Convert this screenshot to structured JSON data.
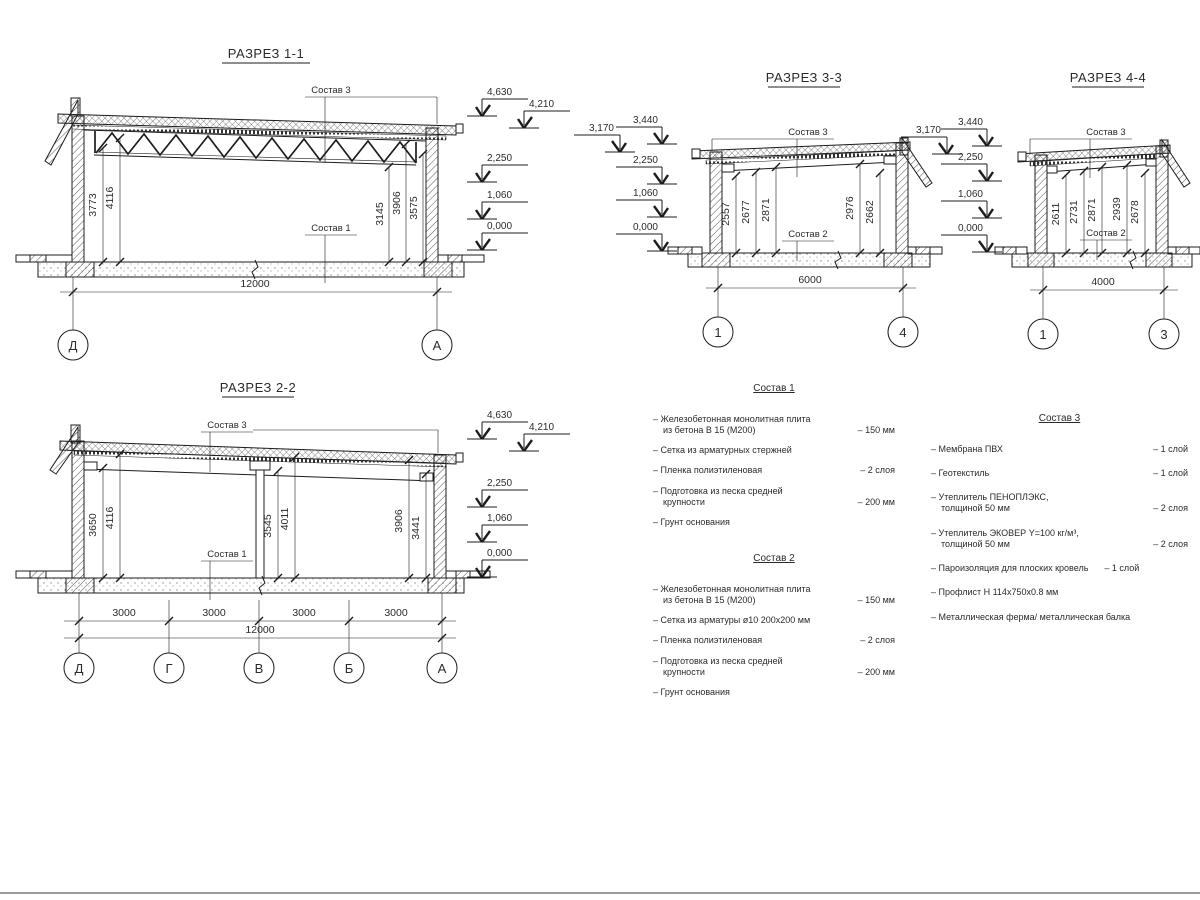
{
  "page": {
    "background": "#ffffff",
    "line_color": "#1c1c1c",
    "text_color": "#2b2b2b",
    "bottom_rule_color": "#9b9b9b"
  },
  "sections": {
    "s11": {
      "title": "РАЗРЕЗ 1-1",
      "top_label": "Состав 3",
      "bottom_label": "Состав 1",
      "dim_left_1": "3773",
      "dim_left_2": "4116",
      "dim_right_1": "3145",
      "dim_right_2": "3906",
      "dim_right_3": "3575",
      "total": "12000",
      "grid_left": "Д",
      "grid_right": "А",
      "elev_1": "4,630",
      "elev_2": "4,210",
      "elev_3": "2,250",
      "elev_4": "1,060",
      "elev_5": "0,000"
    },
    "s22": {
      "title": "РАЗРЕЗ 2-2",
      "top_label": "Состав 3",
      "bottom_label": "Состав 1",
      "dim_1": "3650",
      "dim_2": "4116",
      "dim_3": "3545",
      "dim_4": "4011",
      "dim_5": "3906",
      "dim_6": "3441",
      "span": "3000",
      "total": "12000",
      "grid_1": "Д",
      "grid_2": "Г",
      "grid_3": "В",
      "grid_4": "Б",
      "grid_5": "А",
      "elev_1": "4,630",
      "elev_2": "4,210",
      "elev_3": "2,250",
      "elev_4": "1,060",
      "elev_5": "0,000"
    },
    "s33": {
      "title": "РАЗРЕЗ 3-3",
      "top_label": "Состав 3",
      "bottom_label": "Состав 2",
      "dim_1": "2557",
      "dim_2": "2677",
      "dim_3": "2871",
      "dim_4": "2976",
      "dim_5": "2662",
      "total": "6000",
      "grid_1": "1",
      "grid_2": "4",
      "elev_0": "3,170",
      "elev_1": "3,440",
      "elev_2": "2,250",
      "elev_3": "1,060",
      "elev_4": "0,000"
    },
    "s44": {
      "title": "РАЗРЕЗ 4-4",
      "top_label": "Состав 3",
      "bottom_label": "Состав 2",
      "dim_1": "2611",
      "dim_2": "2731",
      "dim_3": "2871",
      "dim_4": "2939",
      "dim_5": "2678",
      "total": "4000",
      "grid_1": "1",
      "grid_2": "3",
      "elev_0": "3,170",
      "elev_1": "3,440",
      "elev_2": "2,250",
      "elev_3": "1,060",
      "elev_4": "0,000"
    }
  },
  "lists": {
    "s1": {
      "title": "Состав 1",
      "items": [
        {
          "text": "– Железобетонная  монолитная плита\nиз бетона В 15 (М200)",
          "value": "– 150 мм"
        },
        {
          "text": "– Сетка из арматурных стержней",
          "value": ""
        },
        {
          "text": "– Пленка полиэтиленовая",
          "value": "– 2 слоя"
        },
        {
          "text": "– Подготовка из песка средней\nкрупности",
          "value": "– 200 мм"
        },
        {
          "text": "– Грунт основания",
          "value": ""
        }
      ]
    },
    "s2": {
      "title": "Состав 2",
      "items": [
        {
          "text": "– Железобетонная  монолитная плита\nиз бетона В 15 (М200)",
          "value": "– 150 мм"
        },
        {
          "text": "– Сетка из арматуры ø10 200х200 мм",
          "value": ""
        },
        {
          "text": "– Пленка полиэтиленовая",
          "value": "– 2 слоя"
        },
        {
          "text": "– Подготовка из песка средней\nкрупности",
          "value": "– 200 мм"
        },
        {
          "text": "– Грунт основания",
          "value": ""
        }
      ]
    },
    "s3": {
      "title": "Состав 3",
      "items": [
        {
          "text": "– Мембрана ПВХ",
          "value": "– 1 слой"
        },
        {
          "text": "– Геотекстиль",
          "value": "– 1 слой"
        },
        {
          "text": "– Утеплитель ПЕНОПЛЭКС,\nтолщиной 50 мм",
          "value": "– 2 слоя"
        },
        {
          "text": "– Утеплитель ЭКОВЕР Y=100 кг/м³,\nтолщиной 50 мм",
          "value": "– 2 слоя"
        },
        {
          "text": "– Пароизоляция для плоских кровель",
          "value": "– 1 слой"
        },
        {
          "text": "– Профлист Н 114х750х0.8 мм",
          "value": ""
        },
        {
          "text": "– Металлическая ферма/ металлическая балка",
          "value": ""
        }
      ]
    }
  }
}
